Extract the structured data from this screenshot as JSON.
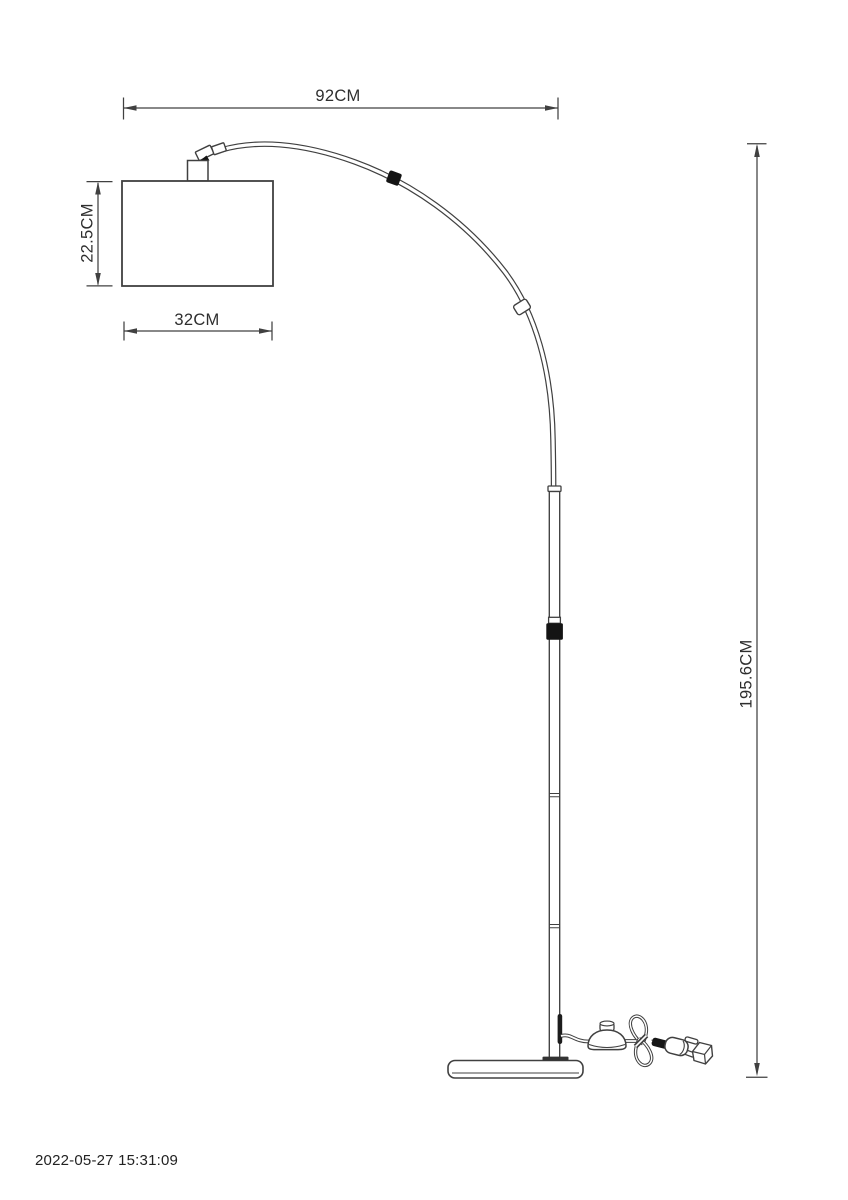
{
  "drawing": {
    "type": "technical-dimension-drawing",
    "subject": "arc floor lamp side view",
    "dimensions": {
      "arc_width": "92CM",
      "shade_height": "22.5CM",
      "shade_width": "32CM",
      "total_height": "195.6CM"
    },
    "timestamp": "2022-05-27 15:31:09",
    "colors": {
      "background": "#ffffff",
      "line": "#404040",
      "black_part": "#141414",
      "text": "#2e2e2e"
    }
  }
}
